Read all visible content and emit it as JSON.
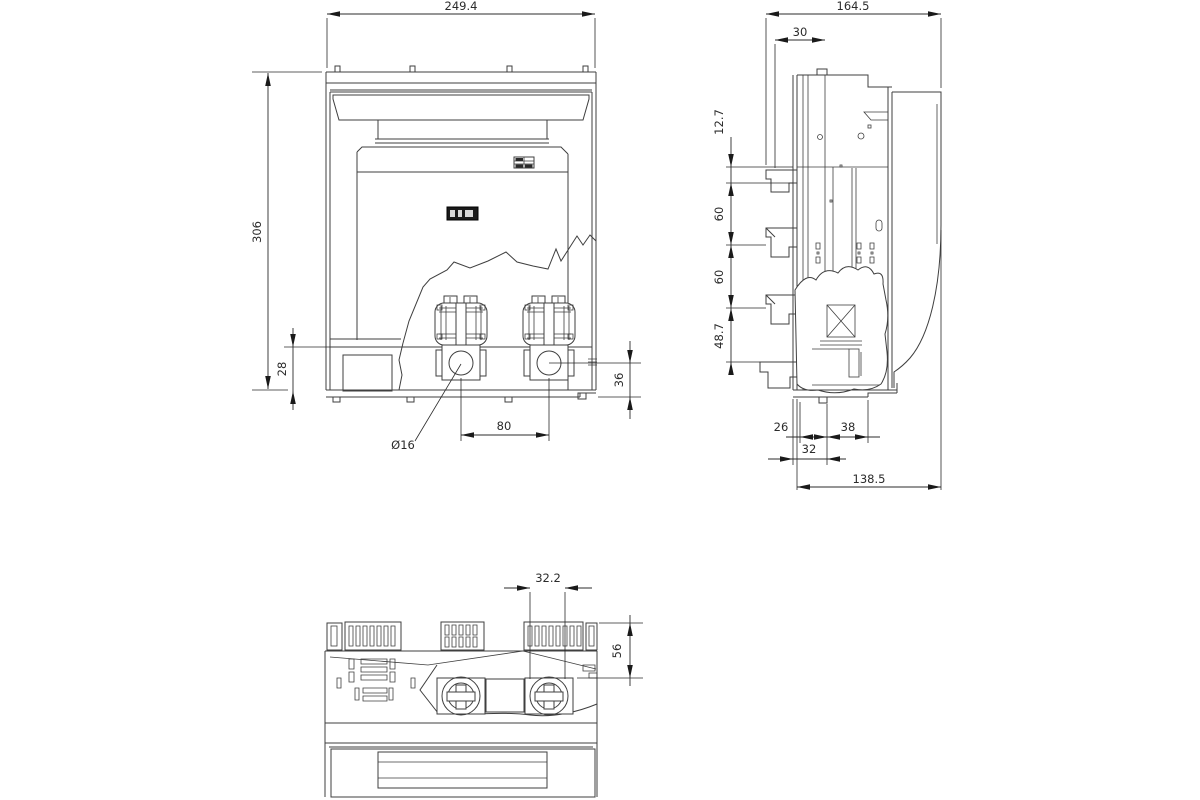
{
  "colors": {
    "line": "#3f3f3f",
    "dimension": "#2b2b2b",
    "background": "#ffffff"
  },
  "dimensions": {
    "front": {
      "width": "249.4",
      "height": "306",
      "band_height": "28",
      "hole_pitch": "80",
      "hole_diameter": "Ø16",
      "base_offset": "36"
    },
    "side": {
      "overall_depth": "164.5",
      "rail_offset": "30",
      "step_1": "12.7",
      "step_2": "60",
      "step_3": "60",
      "step_4": "48.7",
      "foot_a": "26",
      "foot_b": "38",
      "foot_c": "32",
      "overall_base": "138.5"
    },
    "bottom": {
      "terminal_slot": "32.2",
      "depth_offset": "56"
    }
  }
}
